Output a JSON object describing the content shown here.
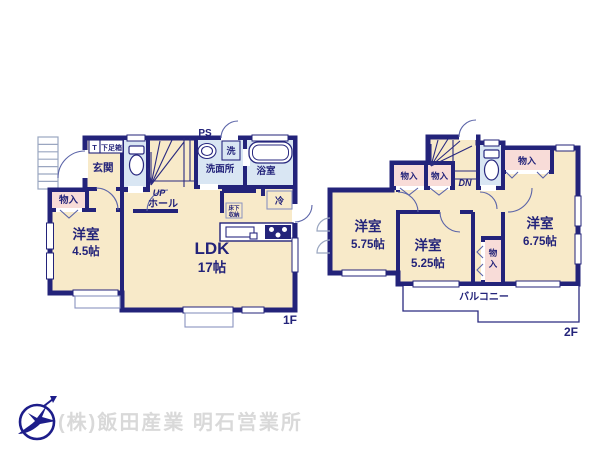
{
  "colors": {
    "wall_navy": "#23237a",
    "room_cream": "#f8eac9",
    "closet_pink": "#f8dcd8",
    "wet_blue": "#d9e6f3",
    "thin_gray_blue": "#9aa6c0",
    "company_text_gray": "#d9d9d9",
    "logo_navy": "#1d1d8a"
  },
  "footer": {
    "company_name": "(株)飯田産業 明石営業所"
  },
  "floor_1": {
    "floor_label": "1F",
    "rooms": {
      "pipe_space": "PS",
      "shoe_t": "T",
      "shoe_box": "下足箱",
      "entrance": "玄関",
      "washer": "洗",
      "washroom": "洗面所",
      "bathroom": "浴室",
      "stairs_up": "UP",
      "hall": "ホール",
      "fridge": "冷",
      "underfloor_1": "床下",
      "underfloor_2": "収納",
      "closet": "物入",
      "bedroom_name": "洋室",
      "bedroom_size": "4.5帖",
      "ldk_name": "LDK",
      "ldk_size": "17帖"
    }
  },
  "floor_2": {
    "floor_label": "2F",
    "rooms": {
      "stairs_down": "DN",
      "closet_a": "物入",
      "closet_b": "物入",
      "closet_c": "物入",
      "closet_vert_1": "物",
      "closet_vert_2": "入",
      "bedroom1_name": "洋室",
      "bedroom1_size": "5.75帖",
      "bedroom2_name": "洋室",
      "bedroom2_size": "5.25帖",
      "bedroom3_name": "洋室",
      "bedroom3_size": "6.75帖",
      "balcony": "バルコニー"
    }
  }
}
